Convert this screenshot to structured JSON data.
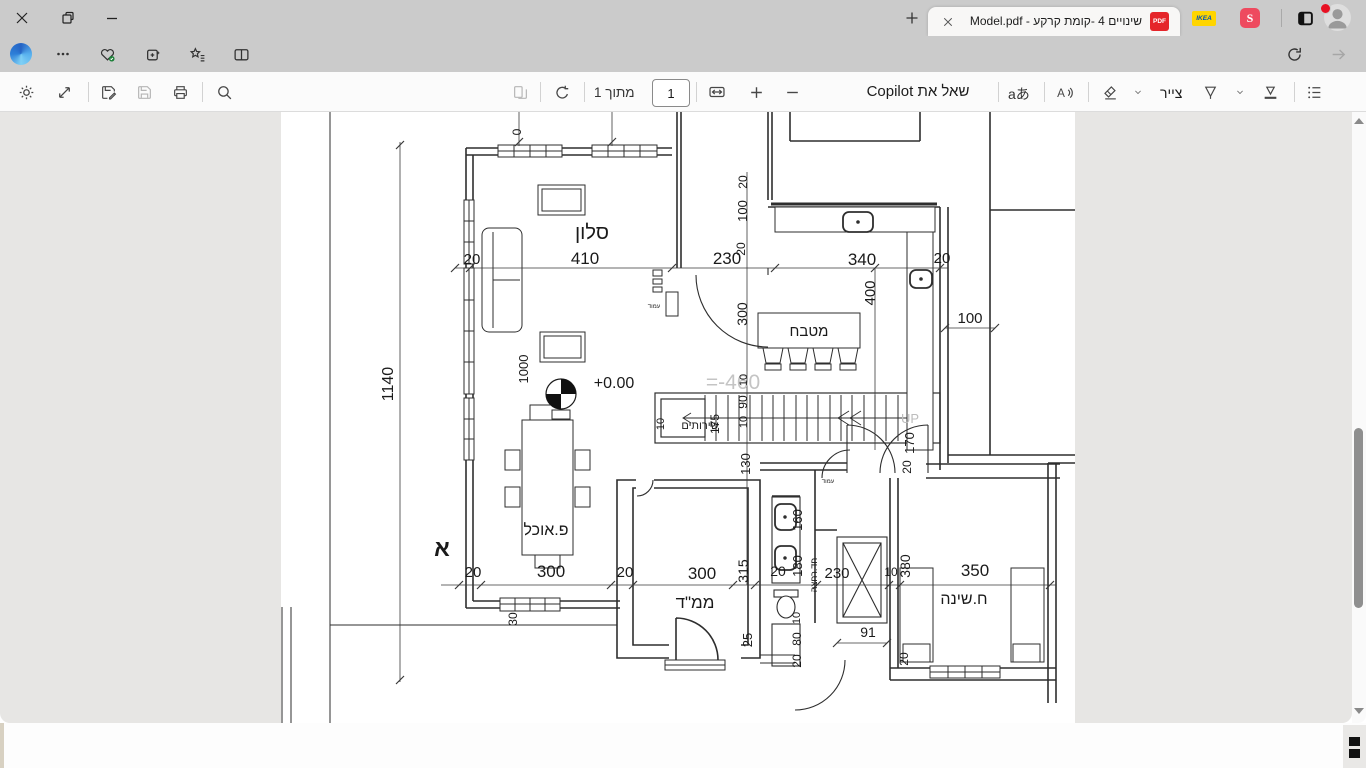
{
  "window": {
    "app": "Microsoft Edge"
  },
  "tabs": {
    "active": {
      "title": "שינויים 4 -קומת קרקע - Model.pdf",
      "file_badge": "PDF"
    },
    "pinned": [
      {
        "name": "ikea",
        "text": "IKEA",
        "bg": "#ffd500",
        "fg": "#0051ba"
      },
      {
        "name": "shufersal",
        "text": "S",
        "bg": "#ee4a5f",
        "fg": "#ffffff"
      }
    ]
  },
  "navbar": {
    "url": "D:/מוריה%20בן%20גרא/Documents/...הצורות%20שלי/אדריכלות/תכניות-אדריכלות/משפחת%20טויטו/שינויים%204%20-%20קומת%20קרק",
    "file_label": "קובץ"
  },
  "pdfbar": {
    "page_value": "1",
    "of_label": "מתוך 1",
    "copilot_label": "שאל את Copilot",
    "translate_label": "aあ",
    "draw_label": "צייר"
  },
  "plan": {
    "accent_gray": "#c4c4c4",
    "labels": [
      {
        "t": "סלון",
        "x": 311,
        "y": 127,
        "s": 20
      },
      {
        "t": "410",
        "x": 304,
        "y": 152,
        "s": 17
      },
      {
        "t": "20",
        "x": 191,
        "y": 152,
        "s": 15
      },
      {
        "t": "230",
        "x": 446,
        "y": 152,
        "s": 17
      },
      {
        "t": "340",
        "x": 581,
        "y": 153,
        "s": 17
      },
      {
        "t": "20",
        "x": 661,
        "y": 151,
        "s": 15
      },
      {
        "t": "100",
        "x": 689,
        "y": 211,
        "s": 15
      },
      {
        "t": "1140",
        "x": 112,
        "y": 272,
        "s": 16,
        "r": -90
      },
      {
        "t": "0",
        "x": 240,
        "y": 20,
        "s": 12,
        "r": -90
      },
      {
        "t": "20",
        "x": 466,
        "y": 70,
        "s": 12,
        "r": -90
      },
      {
        "t": "100",
        "x": 466,
        "y": 99,
        "s": 13,
        "r": -90
      },
      {
        "t": "20",
        "x": 464,
        "y": 137,
        "s": 12,
        "r": -90
      },
      {
        "t": "300",
        "x": 466,
        "y": 202,
        "s": 14,
        "r": -90
      },
      {
        "t": "400",
        "x": 594,
        "y": 181,
        "s": 15,
        "r": -90
      },
      {
        "t": "מטבח",
        "x": 528,
        "y": 224,
        "s": 15
      },
      {
        "t": "=-460",
        "x": 452,
        "y": 277,
        "s": 21,
        "c": "#c4c4c4"
      },
      {
        "t": "+0.00",
        "x": 333,
        "y": 276,
        "s": 16
      },
      {
        "t": "1000",
        "x": 247,
        "y": 257,
        "s": 13,
        "r": -90
      },
      {
        "t": "10",
        "x": 383,
        "y": 312,
        "s": 11,
        "r": -90
      },
      {
        "t": "שירותים",
        "x": 419,
        "y": 317,
        "s": 11
      },
      {
        "t": "175",
        "x": 438,
        "y": 312,
        "s": 12,
        "r": -90
      },
      {
        "t": "10",
        "x": 466,
        "y": 268,
        "s": 11,
        "r": -90
      },
      {
        "t": "90",
        "x": 466,
        "y": 290,
        "s": 12,
        "r": -90
      },
      {
        "t": "10",
        "x": 466,
        "y": 310,
        "s": 11,
        "r": -90
      },
      {
        "t": "130",
        "x": 469,
        "y": 352,
        "s": 13,
        "r": -90
      },
      {
        "t": "UP",
        "x": 629,
        "y": 311,
        "s": 13,
        "c": "#bdbdbd"
      },
      {
        "t": "170",
        "x": 633,
        "y": 331,
        "s": 13,
        "r": -90
      },
      {
        "t": "20",
        "x": 630,
        "y": 355,
        "s": 12,
        "r": -90
      },
      {
        "t": "עמוד",
        "x": 373,
        "y": 196,
        "s": 6
      },
      {
        "t": "עמוד",
        "x": 547,
        "y": 371,
        "s": 6
      },
      {
        "t": "פ.אוכל",
        "x": 265,
        "y": 423,
        "s": 16
      },
      {
        "t": "א",
        "x": 161,
        "y": 444,
        "s": 23,
        "b": 1
      },
      {
        "t": "20",
        "x": 192,
        "y": 465,
        "s": 15
      },
      {
        "t": "300",
        "x": 270,
        "y": 465,
        "s": 17
      },
      {
        "t": "20",
        "x": 344,
        "y": 465,
        "s": 15
      },
      {
        "t": "300",
        "x": 421,
        "y": 467,
        "s": 17
      },
      {
        "t": "ממ\"ד",
        "x": 414,
        "y": 496,
        "s": 17
      },
      {
        "t": "315",
        "x": 467,
        "y": 459,
        "s": 14,
        "r": -90
      },
      {
        "t": "20",
        "x": 497,
        "y": 464,
        "s": 14
      },
      {
        "t": "230",
        "x": 556,
        "y": 466,
        "s": 15
      },
      {
        "t": "10",
        "x": 610,
        "y": 464,
        "s": 12
      },
      {
        "t": "380",
        "x": 629,
        "y": 454,
        "s": 14,
        "r": -90
      },
      {
        "t": "350",
        "x": 694,
        "y": 464,
        "s": 17
      },
      {
        "t": "ח.שינה",
        "x": 683,
        "y": 492,
        "s": 16
      },
      {
        "t": "160",
        "x": 521,
        "y": 408,
        "s": 13,
        "r": -90
      },
      {
        "t": "180",
        "x": 521,
        "y": 454,
        "s": 13,
        "r": -90
      },
      {
        "t": "חד.רחצה",
        "x": 536,
        "y": 463,
        "s": 9,
        "r": -90
      },
      {
        "t": "91",
        "x": 587,
        "y": 525,
        "s": 14
      },
      {
        "t": "10",
        "x": 519,
        "y": 506,
        "s": 11,
        "r": -90
      },
      {
        "t": "80",
        "x": 520,
        "y": 527,
        "s": 12,
        "r": -90
      },
      {
        "t": "20",
        "x": 520,
        "y": 549,
        "s": 12,
        "r": -90
      },
      {
        "t": "25",
        "x": 471,
        "y": 528,
        "s": 13,
        "r": -90
      },
      {
        "t": "30",
        "x": 236,
        "y": 507,
        "s": 12,
        "r": -90
      },
      {
        "t": "20",
        "x": 627,
        "y": 547,
        "s": 12,
        "r": -90
      }
    ]
  }
}
